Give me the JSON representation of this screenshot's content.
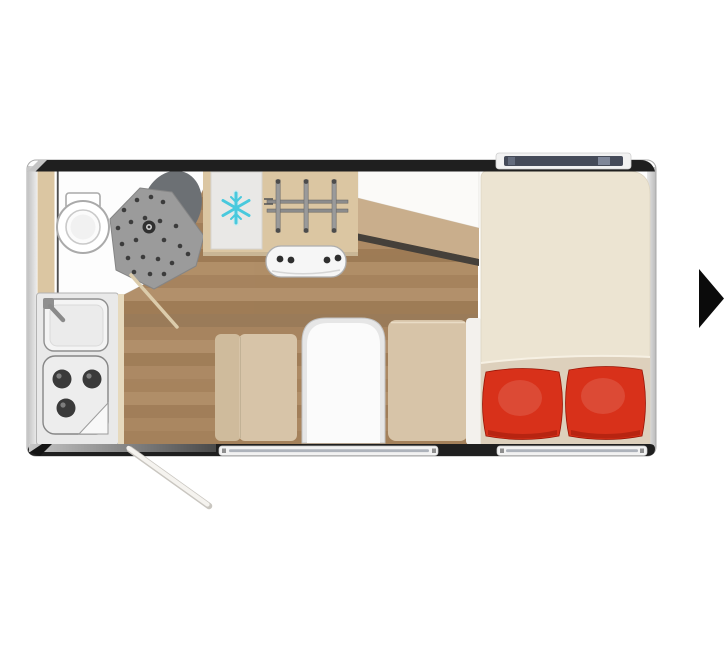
{
  "scene": {
    "description": "Caravan / motorhome floor plan, top view, shown in an image viewer with a next-arrow control",
    "background": "#ffffff"
  },
  "floorplan": {
    "areas": [
      {
        "name": "bathroom",
        "items": [
          "toilet",
          "shower-tray",
          "wash-basin",
          "bathroom-door-open"
        ]
      },
      {
        "name": "kitchen",
        "items": [
          "sink-with-faucet",
          "three-burner-hob",
          "fridge",
          "gas-grate",
          "stove-front-panel"
        ]
      },
      {
        "name": "dinette",
        "items": [
          "bench-seat-left",
          "dinette-table",
          "bench-seat-right"
        ]
      },
      {
        "name": "bedroom",
        "items": [
          "double-bed",
          "pillow-left",
          "pillow-right"
        ]
      },
      {
        "name": "entry",
        "items": [
          "entry-door-open"
        ]
      }
    ],
    "colors": {
      "frame": "#1f1f1f",
      "body": "#fdfdfd",
      "wood_floor": "#a8855f",
      "cabinet": "#dbc6a2",
      "bathroom_floor": "#fdfdfd",
      "shower_tray": "#9b9b9b",
      "shower_dots": "#3c3c3c",
      "basin": "#6c7074",
      "toilet": "#ffffff",
      "fridge": "#e9e8e6",
      "snowflake": "#49c9dd",
      "panel_white": "#f6f6f6",
      "counter": "#e9e9e9",
      "burner": "#3a3a3a",
      "bench": "#d7c4a8",
      "bench_back": "#cfbb9c",
      "table_rim": "#e6e6e6",
      "table_top": "#fbfbfb",
      "bed": "#ece4d2",
      "bed_blanket": "#ddd0bc",
      "pillow": "#d8311a",
      "wedge_shelf": "#fbfaf8",
      "wedge_tan": "#c9ae8c",
      "step_edge": "#45403a",
      "window_glass": "#454b59",
      "window_frame": "#f2f2f2",
      "door_line": "#dcccab",
      "entry_door_line": "#f5f3ef"
    }
  },
  "carousel": {
    "next_button": {
      "icon": "next-arrow-icon",
      "color": "#0b0b0b"
    }
  }
}
